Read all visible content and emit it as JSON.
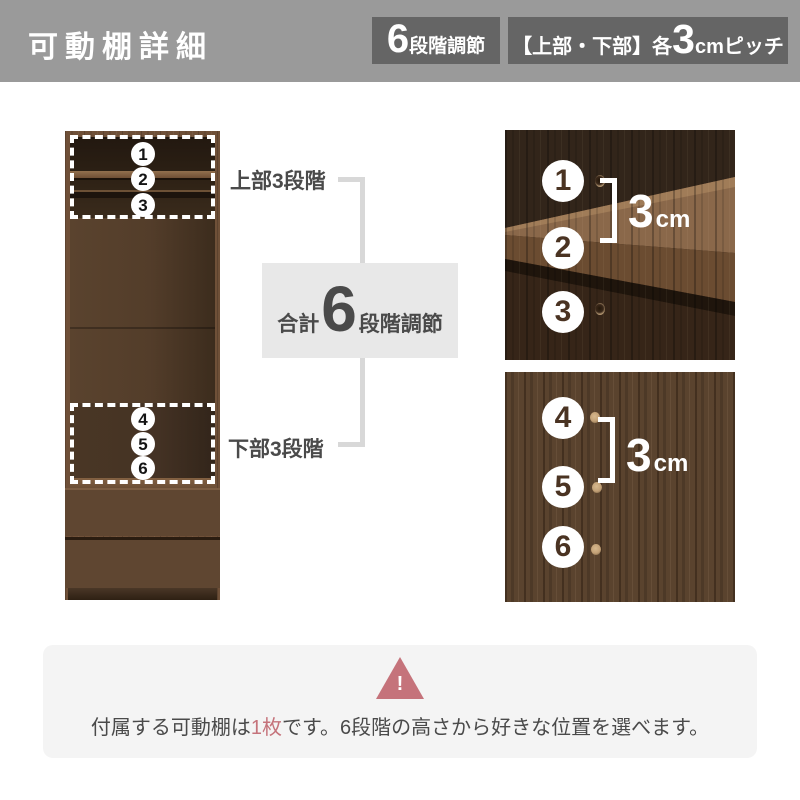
{
  "header": {
    "title": "可動棚詳細",
    "badge_levels": {
      "big": "6",
      "label": "段階調節"
    },
    "badge_pitch": {
      "prefix": "【上部・下部】各",
      "big": "3",
      "suffix": "cmピッチ"
    }
  },
  "diagram": {
    "upper_label": "上部3段階",
    "lower_label": "下部3段階",
    "total": {
      "prefix": "合計",
      "big": "6",
      "suffix": "段階調節"
    },
    "positions": [
      "1",
      "2",
      "3",
      "4",
      "5",
      "6"
    ],
    "photo_upper": {
      "positions": [
        "1",
        "2",
        "3"
      ],
      "measure": {
        "big": "3",
        "unit": "cm"
      }
    },
    "photo_lower": {
      "positions": [
        "4",
        "5",
        "6"
      ],
      "measure": {
        "big": "3",
        "unit": "cm"
      }
    }
  },
  "note": {
    "warning_icon": "warning-triangle-icon",
    "warning_mark": "!",
    "text_start": "付属する可動棚は",
    "highlight": "1枚",
    "text_end": "です。6段階の高さから好きな位置を選べます。"
  },
  "colors": {
    "header_bg": "#9a9a9a",
    "badge_bg": "#656565",
    "text_dark": "#4a4a4a",
    "connector": "#d8d8d8",
    "total_box_bg": "#e8e8e8",
    "note_bg": "#f4f4f4",
    "warning_accent": "#c5737b",
    "wood_dark": "#32251a",
    "wood_mid": "#5a432e"
  }
}
